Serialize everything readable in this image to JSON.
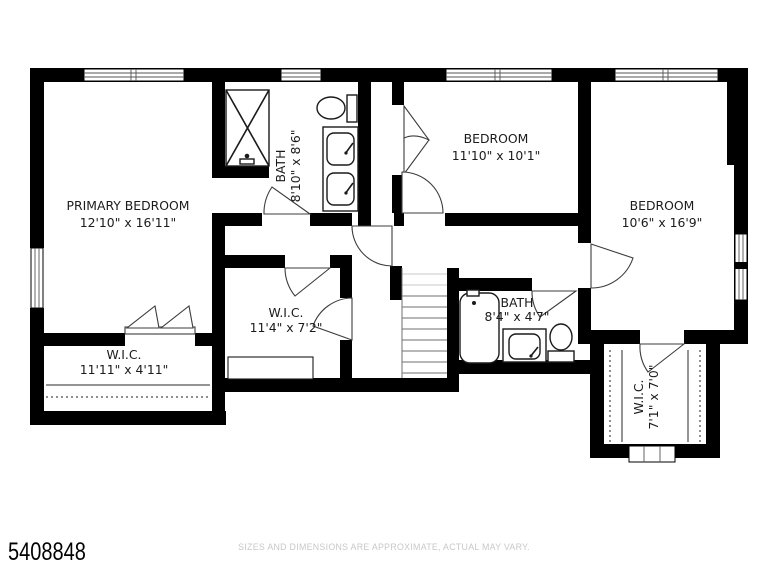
{
  "document": {
    "type": "floor-plan",
    "background": "#ffffff"
  },
  "rooms": {
    "primary_bedroom": {
      "name": "PRIMARY BEDROOM",
      "dims": "12'10\" x 16'11\""
    },
    "bath_primary": {
      "name": "BATH",
      "dims": "8'10\" x 8'6\""
    },
    "bedroom_middle": {
      "name": "BEDROOM",
      "dims": "11'10\" x 10'1\""
    },
    "bedroom_right": {
      "name": "BEDROOM",
      "dims": "10'6\" x 16'9\""
    },
    "wic_hall": {
      "name": "W.I.C.",
      "dims": "11'4\" x 7'2\""
    },
    "wic_primary": {
      "name": "W.I.C.",
      "dims": "11'11\" x 4'11\""
    },
    "bath_hall": {
      "name": "BATH",
      "dims": "8'4\" x 4'7\""
    },
    "wic_right": {
      "name": "W.I.C.",
      "dims": "7'1\" x 7'0\""
    }
  },
  "footer": {
    "listing_id": "5408848",
    "disclaimer": "SIZES AND DIMENSIONS ARE APPROXIMATE, ACTUAL MAY VARY."
  },
  "colors": {
    "wall": "#000000",
    "floor": "#ffffff",
    "disclaimer_text": "#c8c8c8",
    "listing_id_text": "#000000"
  }
}
